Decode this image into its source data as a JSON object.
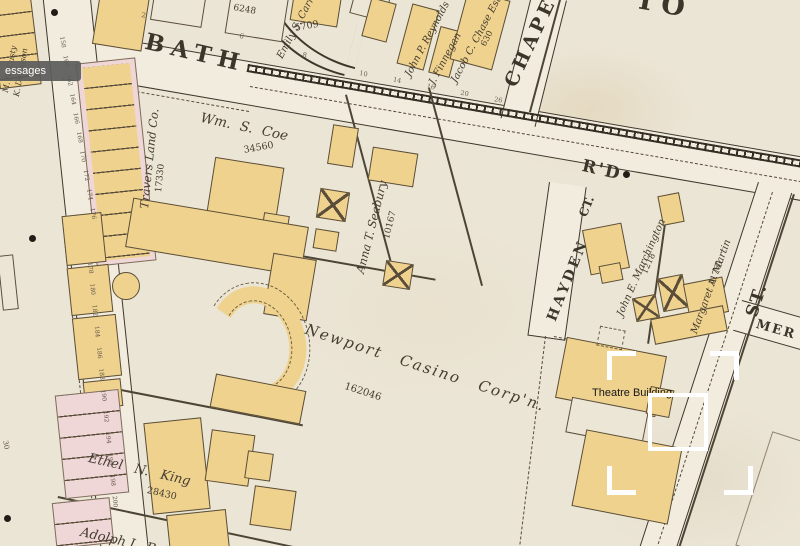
{
  "labels": {
    "streets": {
      "bath": "BATH",
      "rd": "R'D",
      "chapel": "CHAPE",
      "to_partial": "TO",
      "hayden": "HAYDEN",
      "ct": "CT.",
      "st": "ST.",
      "mer_partial": "MER"
    },
    "owners": {
      "travers": {
        "name": "Travers Land Co.",
        "number": "17330"
      },
      "coe": {
        "name": "Wm. S. Coe",
        "number": "34560"
      },
      "seabury": {
        "name": "Anna T. Seabury",
        "number": "10167"
      },
      "carroll": {
        "name": "Emily S. Carroll"
      },
      "reynolds": {
        "name": "John P. Reynolds"
      },
      "finnegan": {
        "name": "J. Finnegan"
      },
      "chase": {
        "name": "Jacob C. Chase Est.",
        "number": "630"
      },
      "casino": {
        "name": "Newport Casino Corp'n.",
        "number": "162046"
      },
      "marchington": {
        "name": "John E. Marchington",
        "number": "1218"
      },
      "martin": {
        "name": "Margaret A. Martin",
        "number": "11761"
      },
      "king": {
        "name": "Ethel N. King",
        "number": "28430"
      },
      "adolph": {
        "name": "Adolph L. Buh"
      },
      "custy": {
        "name": "M. R. Custy"
      },
      "dennison": {
        "name": "K. Dennison"
      }
    },
    "building_numbers": {
      "a": "6248",
      "b": "5709"
    },
    "street_numbers": {
      "n2": "2",
      "n6": "6",
      "n8": "8",
      "south_row": "10 14 16 20 26"
    },
    "lot_numbers": {
      "bellevue_upper": "158 160 162 164 166 168 170 172 174 176",
      "bellevue_lower": "178 180 182 184 186 188 190 192 194 196 198 200",
      "west": "30"
    }
  },
  "annotation": {
    "label": "Theatre Building"
  },
  "tooltip": {
    "text": "essages"
  },
  "colors": {
    "paper": "#ebe5d6",
    "building_yellow": "#efd28e",
    "building_pink": "#efd6d7",
    "map_line": "#3d372c",
    "annotation_white": "#ffffff",
    "annotation_text": "#161616",
    "tooltip_bg": "#5c5c5c"
  }
}
